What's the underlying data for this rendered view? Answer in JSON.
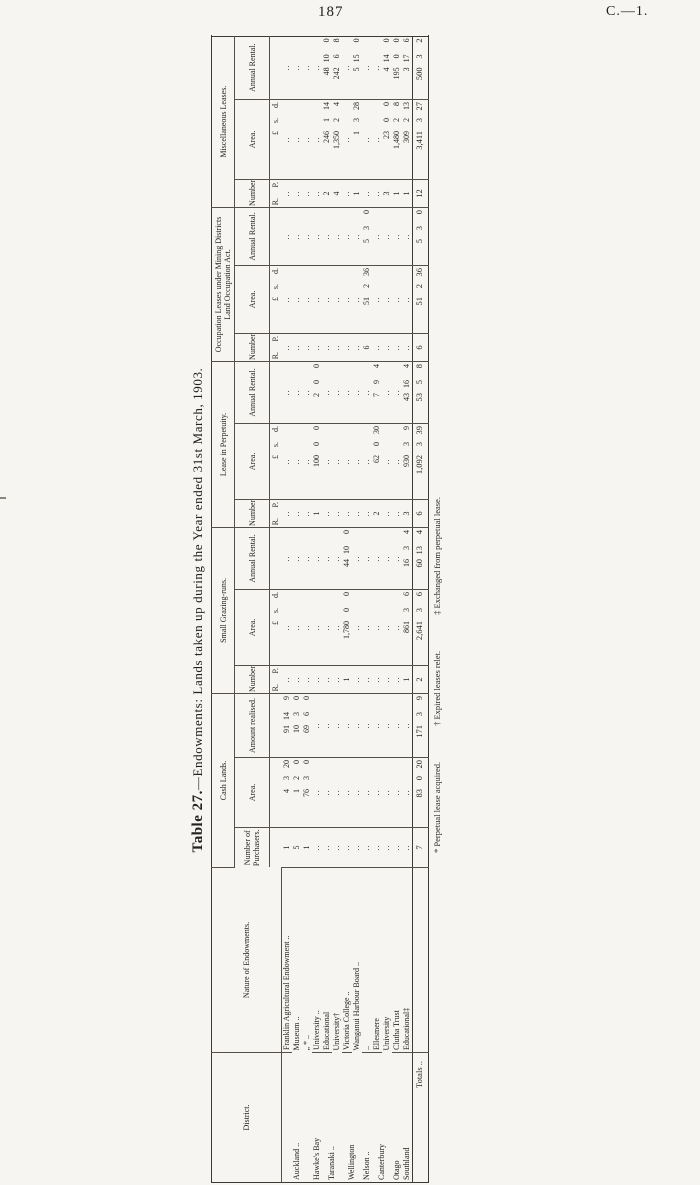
{
  "page": {
    "number": "187",
    "doc_ref": "C.—1."
  },
  "table": {
    "title_bold": "Table 27.",
    "title_rest": "—Endowments: Lands taken up during the Year ended 31st March, 1903.",
    "district_header": "District.",
    "nature_header": "Nature of Endowments.",
    "totals_label": "Totals ..",
    "groups": [
      {
        "label": "Cash Lands.",
        "cols": [
          "Number of Purchasers.",
          "Area.",
          "Amount realised."
        ],
        "units": [
          "",
          "A. R. P.",
          "£ s. d."
        ],
        "types": [
          "num",
          "trip",
          "trip"
        ]
      },
      {
        "label": "Small Grazing-runs.",
        "cols": [
          "Number.",
          "Area.",
          "Annual Rental."
        ],
        "units": [
          "",
          "A. R. P.",
          "£ s. d."
        ],
        "types": [
          "num",
          "trip",
          "trip"
        ]
      },
      {
        "label": "Lease in Perpetuity.",
        "cols": [
          "Number.",
          "Area.",
          "Annual Rental."
        ],
        "units": [
          "",
          "A. R. P.",
          "£ s. d."
        ],
        "types": [
          "num",
          "trip",
          "trip"
        ]
      },
      {
        "label": "Occupation Leases under Mining Districts Land Occupation Act.",
        "cols": [
          "Number.",
          "Area.",
          "Annual Rental."
        ],
        "units": [
          "",
          "A. R. P.",
          "£ s. d."
        ],
        "types": [
          "num",
          "trip",
          "trip"
        ]
      },
      {
        "label": "Miscellaneous Leases.",
        "cols": [
          "Number.",
          "Area.",
          "Annual Rental."
        ],
        "units": [
          "",
          "A. R. P.",
          "£ s. d."
        ],
        "types": [
          "num",
          "trip",
          "trip"
        ]
      }
    ],
    "rows": [
      {
        "district": "Auckland ..",
        "span": 3,
        "nature": "Franklin Agricultural Endowment ..",
        "cells": [
          "1",
          "4 3 20",
          "91 14 9",
          "..",
          "..",
          "..",
          "..",
          "..",
          "..",
          "..",
          "..",
          "..",
          "..",
          "..",
          ".."
        ]
      },
      {
        "nature": "Museum ..",
        "cells": [
          "5",
          "1 2 0",
          "10 3 0",
          "..",
          "..",
          "..",
          "..",
          "..",
          "..",
          "..",
          "..",
          "..",
          "..",
          "..",
          ".."
        ]
      },
      {
        "nature": "„ * ..",
        "cells": [
          "1",
          "76 3 0",
          "69 6 0",
          "..",
          "..",
          "..",
          "..",
          "..",
          "..",
          "..",
          "..",
          "..",
          "..",
          "..",
          ".."
        ]
      },
      {
        "district": "Hawke's Bay",
        "span": 1,
        "nature": "University ..",
        "cells": [
          "..",
          "..",
          "..",
          "..",
          "..",
          "..",
          "1",
          "100 0 0",
          "2 0 0",
          "..",
          "..",
          "..",
          "..",
          "..",
          ".."
        ]
      },
      {
        "district": "Taranaki ..",
        "span": 2,
        "nature": "Educational",
        "cells": [
          "..",
          "..",
          "..",
          "..",
          "..",
          "..",
          "..",
          "..",
          "..",
          "..",
          "..",
          "..",
          "2",
          "246 1 14",
          "48 10 0"
        ]
      },
      {
        "nature": "University†",
        "cells": [
          "..",
          "..",
          "..",
          "..",
          "..",
          "..",
          "..",
          "..",
          "..",
          "..",
          "..",
          "..",
          "4",
          "1,350 2 4",
          "242 6 8"
        ]
      },
      {
        "district": "Wellington",
        "span": 2,
        "nature": "Victoria College ..",
        "cells": [
          "..",
          "..",
          "..",
          "1",
          "1,780 0 0",
          "44 10 0",
          "..",
          "..",
          "..",
          "..",
          "..",
          "..",
          "..",
          "..",
          ".."
        ]
      },
      {
        "nature": "Wanganui Harbour Board ..",
        "cells": [
          "..",
          "..",
          "..",
          "..",
          "..",
          "..",
          "..",
          "..",
          "..",
          "..",
          "..",
          "..",
          "1",
          "1 3 28",
          "5 15 0"
        ]
      },
      {
        "district": "Nelson ..",
        "span": 1,
        "nature": "..",
        "cells": [
          "..",
          "..",
          "..",
          "..",
          "..",
          "..",
          "..",
          "..",
          "..",
          "6",
          "51 2 36",
          "5 3 0",
          "..",
          "..",
          ".."
        ]
      },
      {
        "district": "Canterbury",
        "span": 2,
        "nature": "Ellesmere",
        "cells": [
          "..",
          "..",
          "..",
          "..",
          "..",
          "..",
          "2",
          "62 0 30",
          "7 9 4",
          "..",
          "..",
          "..",
          "..",
          "..",
          ".."
        ]
      },
      {
        "nature": "University",
        "cells": [
          "..",
          "..",
          "..",
          "..",
          "..",
          "..",
          "..",
          "..",
          "..",
          "..",
          "..",
          "..",
          "3",
          "23 0 0",
          "4 14 0"
        ]
      },
      {
        "district": "Otago",
        "span": 1,
        "nature": "Clutha Trust",
        "cells": [
          "..",
          "..",
          "..",
          "..",
          "..",
          "..",
          "..",
          "..",
          "..",
          "..",
          "..",
          "..",
          "1",
          "1,480 2 8",
          "195 0 0"
        ]
      },
      {
        "district": "Southland",
        "span": 1,
        "nature": "Educational‡",
        "cells": [
          "..",
          "..",
          "..",
          "1",
          "861 3 6",
          "16 3 4",
          "3",
          "930 3 9",
          "43 16 4",
          "..",
          "..",
          "..",
          "1",
          "309 2 13",
          "3 17 6"
        ]
      }
    ],
    "totals": [
      "7",
      "83 0 20",
      "171 3 9",
      "2",
      "2,641 3 6",
      "60 13 4",
      "6",
      "1,092 3 39",
      "53 5 8",
      "6",
      "51 2 36",
      "5 3 0",
      "12",
      "3,411 3 27",
      "500 3 2"
    ],
    "footnotes": [
      "* Perpetual lease acquired.",
      "† Expired leases relet.",
      "‡ Exchanged from perpetual lease."
    ]
  }
}
